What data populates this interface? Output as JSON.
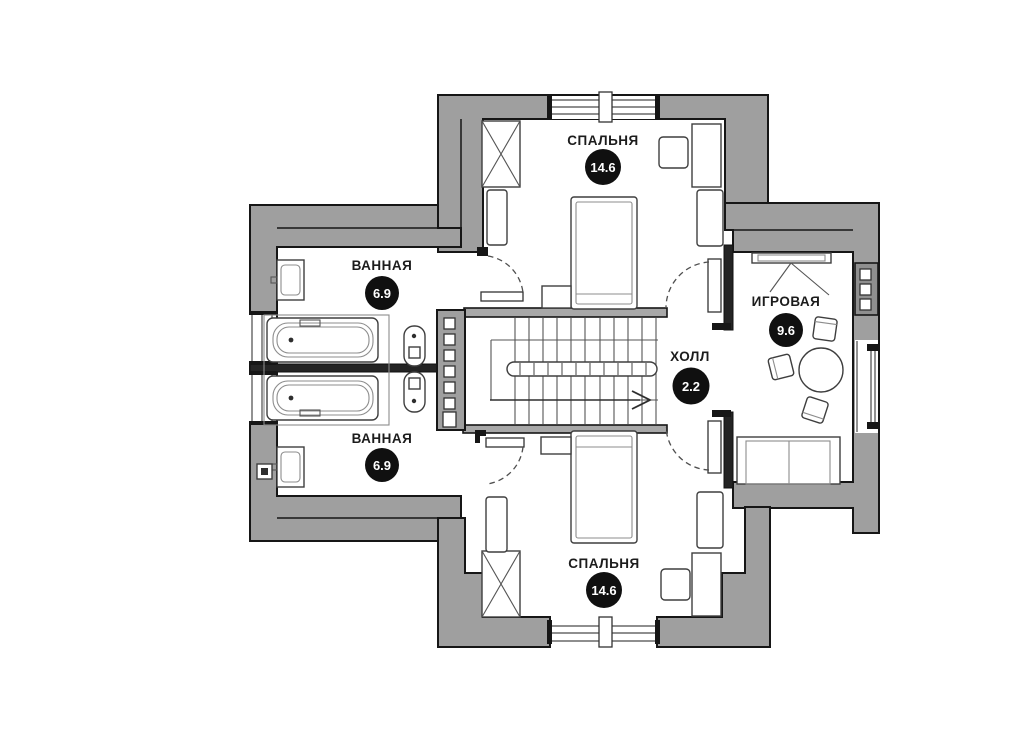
{
  "plan": {
    "type": "floor-plan",
    "wall_color": "#9f9f9f",
    "outline_color": "#161616",
    "marker": {
      "bg": "#101010",
      "text_color": "#ffffff"
    },
    "rooms": [
      {
        "id": "bedroom-top",
        "label": "СПАЛЬНЯ",
        "area": "14.6"
      },
      {
        "id": "bathroom-upper",
        "label": "ВАННАЯ",
        "area": "6.9"
      },
      {
        "id": "bathroom-lower",
        "label": "ВАННАЯ",
        "area": "6.9"
      },
      {
        "id": "hall",
        "label": "ХОЛЛ",
        "area": "2.2"
      },
      {
        "id": "playroom",
        "label": "ИГРОВАЯ",
        "area": "9.6"
      },
      {
        "id": "bedroom-bottom",
        "label": "СПАЛЬНЯ",
        "area": "14.6"
      }
    ]
  }
}
